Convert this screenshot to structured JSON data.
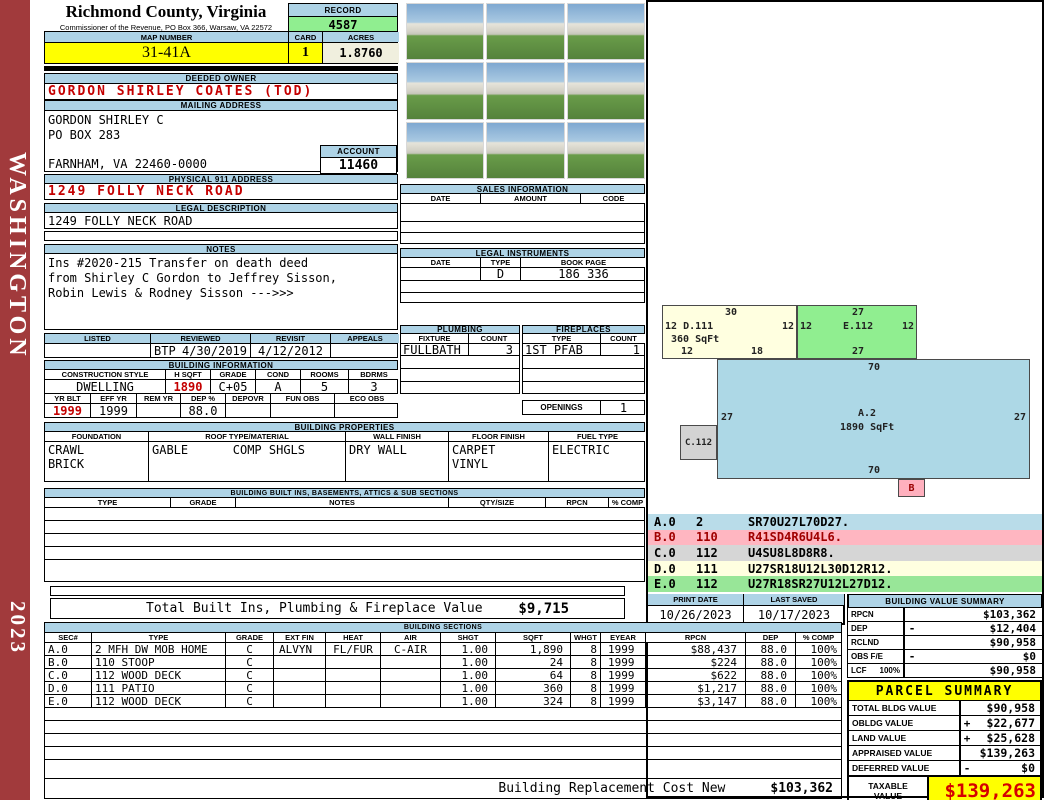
{
  "sidebar": {
    "district": "WASHINGTON",
    "year": "2023"
  },
  "header": {
    "title": "Richmond County, Virginia",
    "subtitle": "Commissioner of the Revenue, PO Box 366, Warsaw, VA 22572",
    "record_label": "RECORD",
    "record_value": "4587",
    "map_number_label": "MAP NUMBER",
    "map_number": "31-41A",
    "card_label": "CARD",
    "card_value": "1",
    "acres_label": "ACRES",
    "acres_value": "1.8760"
  },
  "owner": {
    "deeded_owner_label": "DEEDED OWNER",
    "deeded_owner": "GORDON SHIRLEY COATES (TOD)",
    "mailing_label": "MAILING ADDRESS",
    "mailing_line1": "GORDON SHIRLEY C",
    "mailing_line2": "PO BOX 283",
    "mailing_line3": "FARNHAM, VA 22460-0000",
    "account_label": "ACCOUNT",
    "account_value": "11460",
    "physical_label": "PHYSICAL 911 ADDRESS",
    "physical_address": "1249 FOLLY NECK ROAD",
    "legal_label": "LEGAL DESCRIPTION",
    "legal_description": "1249 FOLLY NECK ROAD"
  },
  "notes": {
    "label": "NOTES",
    "line1": "Ins #2020-215 Transfer on death deed",
    "line2": "from Shirley C Gordon to Jeffrey Sisson,",
    "line3": "Robin Lewis & Rodney Sisson  --->>>"
  },
  "review": {
    "listed_label": "LISTED",
    "reviewed_label": "REVIEWED",
    "revisit_label": "REVISIT",
    "appeals_label": "APPEALS",
    "reviewed_by": "BTP",
    "reviewed_date": "4/30/2019",
    "revisit_date": "4/12/2012"
  },
  "building_info": {
    "title": "BUILDING INFORMATION",
    "h1": [
      "CONSTRUCTION STYLE",
      "H SQFT",
      "GRADE",
      "COND",
      "ROOMS",
      "BDRMS"
    ],
    "v1": [
      "DWELLING",
      "1890",
      "C+05",
      "A",
      "5",
      "3"
    ],
    "h2": [
      "YR BLT",
      "EFF YR",
      "REM YR",
      "DEP %",
      "DEPOVR",
      "FUN OBS",
      "ECO OBS"
    ],
    "v2": [
      "1999",
      "1999",
      "",
      "88.0",
      "",
      "",
      ""
    ]
  },
  "building_properties": {
    "title": "BUILDING PROPERTIES",
    "foundation_label": "FOUNDATION",
    "foundation1": "CRAWL",
    "foundation2": "BRICK",
    "roof_label": "ROOF TYPE/MATERIAL",
    "roof_type": "GABLE",
    "roof_material": "COMP SHGLS",
    "wall_label": "WALL FINISH",
    "wall": "DRY WALL",
    "floor_label": "FLOOR FINISH",
    "floor1": "CARPET",
    "floor2": "VINYL",
    "fuel_label": "FUEL TYPE",
    "fuel": "ELECTRIC"
  },
  "built_ins": {
    "title": "BUILDING BUILT INS, BASEMENTS, ATTICS & SUB SECTIONS",
    "headers": [
      "TYPE",
      "GRADE",
      "NOTES",
      "QTY/SIZE",
      "RPCN",
      "% COMP"
    ],
    "total_label": "Total Built Ins, Plumbing & Fireplace Value",
    "total_value": "$9,715"
  },
  "sales": {
    "title": "SALES INFORMATION",
    "headers": [
      "DATE",
      "AMOUNT",
      "CODE"
    ]
  },
  "instruments": {
    "title": "LEGAL INSTRUMENTS",
    "headers": [
      "DATE",
      "TYPE",
      "BOOK PAGE"
    ],
    "row": {
      "date": "",
      "type": "D",
      "book_page": "186 336"
    }
  },
  "plumbing": {
    "title": "PLUMBING",
    "fixture_label": "FIXTURE",
    "count_label": "COUNT",
    "fixture": "FULLBATH",
    "count": "3"
  },
  "fireplaces": {
    "title": "FIREPLACES",
    "type_label": "TYPE",
    "count_label": "COUNT",
    "type": "1ST PFAB",
    "count": "1",
    "openings_label": "OPENINGS",
    "openings": "1"
  },
  "sketch": {
    "d111": {
      "top": "30",
      "left_dim": "12",
      "name": "D.111",
      "right_dim": "12",
      "sqft": "360 SqFt",
      "bottom_left": "12",
      "bottom_right": "18"
    },
    "e112": {
      "top": "27",
      "left_dim": "12",
      "name": "E.112",
      "right_dim": "12",
      "bottom": "27"
    },
    "a2": {
      "top": "70",
      "left_dim": "27",
      "name": "A.2",
      "sqft": "1890 SqFt",
      "right_dim": "27",
      "bottom": "70"
    },
    "c112": {
      "name": "C.112"
    },
    "b": {
      "name": "B"
    }
  },
  "legend": {
    "rows": [
      {
        "code": "A.0",
        "num": "2",
        "path": "SR70U27L70D27."
      },
      {
        "code": "B.0",
        "num": "110",
        "path": "R41SD4R6U4L6."
      },
      {
        "code": "C.0",
        "num": "112",
        "path": "U4SU8L8D8R8."
      },
      {
        "code": "D.0",
        "num": "111",
        "path": "U27SR18U12L30D12R12."
      },
      {
        "code": "E.0",
        "num": "112",
        "path": "U27R18SR27U12L27D12."
      }
    ]
  },
  "meta": {
    "print_date_label": "PRINT DATE",
    "print_date": "10/26/2023",
    "last_saved_label": "LAST SAVED",
    "last_saved": "10/17/2023"
  },
  "building_value_summary": {
    "title": "BUILDING VALUE SUMMARY",
    "rows": [
      {
        "label": "RPCN",
        "extra": "",
        "op": "",
        "value": "$103,362"
      },
      {
        "label": "DEP",
        "extra": "",
        "op": "-",
        "value": "$12,404"
      },
      {
        "label": "RCLND",
        "extra": "",
        "op": "",
        "value": "$90,958"
      },
      {
        "label": "OBS F/E",
        "extra": "",
        "op": "-",
        "value": "$0"
      },
      {
        "label": "LCF",
        "extra": "100%",
        "op": "",
        "value": "$90,958"
      }
    ]
  },
  "building_sections": {
    "title": "BUILDING SECTIONS",
    "headers": [
      "SEC#",
      "TYPE",
      "GRADE",
      "EXT FIN",
      "HEAT",
      "AIR",
      "SHGT",
      "SQFT",
      "WHGT",
      "EYEAR",
      "RPCN",
      "DEP",
      "% COMP"
    ],
    "rows": [
      [
        "A.0",
        "2 MFH DW MOB HOME",
        "C",
        "ALVYN",
        "FL/FUR",
        "C-AIR",
        "1.00",
        "1,890",
        "8",
        "1999",
        "$88,437",
        "88.0",
        "100%"
      ],
      [
        "B.0",
        "110 STOOP",
        "C",
        "",
        "",
        "",
        "1.00",
        "24",
        "8",
        "1999",
        "$224",
        "88.0",
        "100%"
      ],
      [
        "C.0",
        "112 WOOD DECK",
        "C",
        "",
        "",
        "",
        "1.00",
        "64",
        "8",
        "1999",
        "$622",
        "88.0",
        "100%"
      ],
      [
        "D.0",
        "111 PATIO",
        "C",
        "",
        "",
        "",
        "1.00",
        "360",
        "8",
        "1999",
        "$1,217",
        "88.0",
        "100%"
      ],
      [
        "E.0",
        "112 WOOD DECK",
        "C",
        "",
        "",
        "",
        "1.00",
        "324",
        "8",
        "1999",
        "$3,147",
        "88.0",
        "100%"
      ]
    ],
    "footer_label": "Building Replacement Cost New",
    "footer_value": "$103,362"
  },
  "parcel_summary": {
    "title": "PARCEL SUMMARY",
    "rows": [
      {
        "label": "TOTAL BLDG VALUE",
        "op": "",
        "value": "$90,958"
      },
      {
        "label": "OBLDG VALUE",
        "op": "+",
        "value": "$22,677"
      },
      {
        "label": "LAND VALUE",
        "op": "+",
        "value": "$25,628"
      },
      {
        "label": "APPRAISED VALUE",
        "op": "",
        "value": "$139,263"
      },
      {
        "label": "DEFERRED VALUE",
        "op": "-",
        "value": "$0"
      }
    ],
    "taxable_label1": "TAXABLE",
    "taxable_label2": "VALUE",
    "taxable_value": "$139,263"
  }
}
